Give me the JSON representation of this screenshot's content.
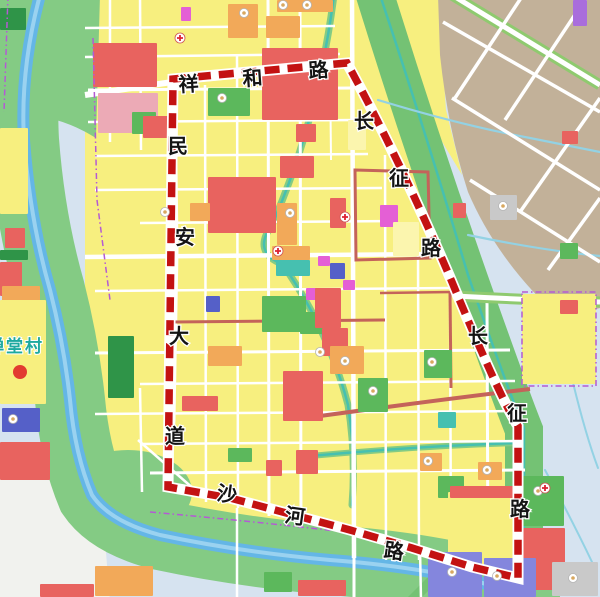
{
  "map": {
    "title": "urban planning zoning map with red dashed project boundary",
    "palette": {
      "bg": "#d6e3f0",
      "whitezone": "#f1f2ee",
      "yellow": "#f7ef7f",
      "yellow2": "#fbf5ae",
      "tan": "#c2b199",
      "corridor": "#84cb84",
      "band": "#74c274",
      "green": "#5cb85c",
      "dkgreen": "#2f9448",
      "river": "#64b6e6",
      "riverlight": "#9ad2f0",
      "stream": "#46c0b0",
      "lightstream": "#93d2e4",
      "red": "#e8635f",
      "pink": "#ecaab6",
      "orange": "#f2a959",
      "magenta": "#e45fd5",
      "blue": "#5560c8",
      "purpleblue": "#8486dd",
      "purple": "#a96ddc",
      "gray": "#c9c9c9",
      "white": "#ffffff",
      "brick": "#c4635a",
      "boundary": "#c31212",
      "casing": "#ffffff",
      "purpleline": "#b45ad4",
      "label": "#141414",
      "village": "#1ea9a0",
      "roadgreen": "#8fca6f"
    },
    "base": [
      {
        "d": "M-5,-5 L605,-5 L605,602 L-5,602 Z",
        "c": "bg"
      },
      {
        "d": "M-5,462 L55,472 Q70,510 105,540 L110,602 L-5,602 Z",
        "c": "whitezone"
      },
      {
        "d": "M85,-5 L360,-5 Q405,155 455,285 Q500,398 518,428 L518,568 L160,568 L148,520 L85,498 Z",
        "c": "yellow"
      },
      {
        "d": "M368,-5 L438,-5 L446,110 L462,175 L428,118 Q398,58 386,18 Z",
        "c": "yellow"
      },
      {
        "d": "M438,-5 L600,-5 L600,308 L560,318 Q498,262 468,192 Q448,130 440,55 Z",
        "c": "tan"
      },
      {
        "d": "M-5,-5 L100,-5 L96,138 Q48,108 -5,116 Z",
        "c": "corridor"
      },
      {
        "e": [
          128,
          492,
          64,
          42
        ],
        "c": "corridor"
      }
    ],
    "corridor_strokes": [
      {
        "d": "M40,-5 Q20,70 24,140 Q30,220 50,290 Q64,345 70,400 Q75,455 92,495 Q110,522 160,535 Q240,552 330,560 Q410,566 470,580 Q505,588 525,597",
        "c": "corridor",
        "w": 70
      },
      {
        "d": "M375,-5 Q420,140 470,282 Q510,395 524,430 L524,540",
        "c": "band",
        "w": 38
      },
      {
        "d": "M412,600 L468,544",
        "c": "band",
        "w": 10
      },
      {
        "d": "M40,-5 Q20,70 24,140 Q30,220 50,290 Q64,345 70,400 Q75,455 92,495 Q110,522 160,535 Q240,552 330,560 Q410,566 470,580 Q505,588 525,597",
        "c": "river",
        "w": 12
      },
      {
        "d": "M40,-5 Q20,70 24,140 Q30,220 50,290 Q64,345 70,400 Q75,455 92,495 Q110,522 160,535 Q240,552 330,560 Q410,566 470,580 Q505,588 525,597",
        "c": "riverlight",
        "w": 4
      }
    ],
    "streams": [
      {
        "d": "M334,-5 Q318,120 272,225 Q252,252 282,264",
        "w": 2.5,
        "c": "stream",
        "case": 7
      },
      {
        "d": "M288,272 Q330,335 348,405 Q356,455 352,505",
        "w": 2.5,
        "c": "stream",
        "case": 7
      },
      {
        "d": "M310,456 Q420,446 518,443",
        "w": 2.5,
        "c": "stream",
        "case": 6
      },
      {
        "d": "M380,-5 Q425,130 468,275 Q508,390 524,428 L524,535",
        "w": 2.5,
        "c": "stream"
      },
      {
        "d": "M378,100 Q460,125 530,138 Q570,146 600,152",
        "w": 2.2,
        "c": "lightstream"
      },
      {
        "d": "M468,235 Q540,250 600,256",
        "w": 2.2,
        "c": "lightstream"
      },
      {
        "d": "M560,325 Q580,420 598,468",
        "w": 2,
        "c": "lightstream"
      },
      {
        "d": "M545,470 Q572,520 592,562",
        "w": 2,
        "c": "lightstream"
      }
    ],
    "roads": [
      {
        "d": "M85,95 L172,82 L347,65",
        "w": 6
      },
      {
        "d": "M174,80 L176,250 L173,420 L168,488",
        "w": 5
      },
      {
        "d": "M110,-5 L110,142",
        "w": 2.5
      },
      {
        "d": "M140,-5 L141,150",
        "w": 2.5
      },
      {
        "d": "M140,388 L142,492",
        "w": 2.5
      },
      {
        "d": "M205,85 L206,502",
        "w": 2.5
      },
      {
        "d": "M237,56 L238,508",
        "w": 2.5
      },
      {
        "d": "M237,508 L237,600",
        "w": 2.5
      },
      {
        "d": "M268,-5 L269,516",
        "w": 3
      },
      {
        "d": "M300,-5 L301,528",
        "w": 3
      },
      {
        "d": "M330,62 L331,160",
        "w": 2
      },
      {
        "d": "M352,-5 L353,250",
        "w": 4.5
      },
      {
        "d": "M353,250 L354,558",
        "w": 4.5
      },
      {
        "d": "M354,558 L354,600",
        "w": 3
      },
      {
        "d": "M385,155 L386,560",
        "w": 2.5
      },
      {
        "d": "M418,255 L419,560",
        "w": 2.5
      },
      {
        "d": "M450,292 L451,566",
        "w": 2.5
      },
      {
        "d": "M487,300 L488,572",
        "w": 3
      },
      {
        "d": "M420,548 L421,600",
        "w": 2.5
      },
      {
        "d": "M85,28 L335,26",
        "w": 2.5
      },
      {
        "d": "M85,57 L340,54",
        "w": 2.5
      },
      {
        "d": "M88,90 L352,88",
        "w": 3
      },
      {
        "d": "M88,122 L358,120",
        "w": 2.5
      },
      {
        "d": "M95,156 L368,154",
        "w": 2.5
      },
      {
        "d": "M95,190 L382,188",
        "w": 2.5
      },
      {
        "d": "M140,223 L395,221",
        "w": 2.5
      },
      {
        "d": "M85,257 L435,254",
        "w": 4.5
      },
      {
        "d": "M95,291 L452,288",
        "w": 2.5
      },
      {
        "d": "M95,353 L510,350",
        "w": 3
      },
      {
        "d": "M140,384 L515,381",
        "w": 2.5
      },
      {
        "d": "M95,414 L518,411",
        "w": 2.5
      },
      {
        "d": "M140,444 L518,441",
        "w": 2.5
      },
      {
        "d": "M150,473 L525,470",
        "w": 3
      },
      {
        "d": "M138,440 L195,490",
        "w": 2.5
      },
      {
        "d": "M452,-5 L600,85",
        "w": 5,
        "case": {
          "c": "roadgreen",
          "w": 11
        }
      },
      {
        "d": "M443,22 L600,112",
        "w": 3.5
      },
      {
        "d": "M452,98 L600,190",
        "w": 3.5
      },
      {
        "d": "M470,180 L600,262",
        "w": 3.5
      },
      {
        "d": "M523,-5 L455,98",
        "w": 3.5
      },
      {
        "d": "M588,-5 L505,120",
        "w": 3.5
      },
      {
        "d": "M600,98 L520,212",
        "w": 3.5
      },
      {
        "d": "M600,198 L548,270",
        "w": 3.5
      },
      {
        "d": "M455,296 Q530,300 600,302",
        "w": 5,
        "case": {
          "c": "roadgreen",
          "w": 11
        }
      },
      {
        "d": "M355,170 L428,172 L430,258 L356,260 Z",
        "w": 3,
        "c": "brick"
      },
      {
        "d": "M172,322 L385,320",
        "w": 3,
        "c": "brick"
      },
      {
        "d": "M320,416 Q430,401 530,389",
        "w": 4,
        "c": "brick"
      },
      {
        "d": "M450,292 L451,388",
        "w": 3,
        "c": "brick"
      },
      {
        "d": "M380,293 L452,292",
        "w": 2.5,
        "c": "brick"
      }
    ],
    "parcels": [
      [
        93,
        43,
        64,
        44,
        "red"
      ],
      [
        98,
        93,
        60,
        40,
        "pink"
      ],
      [
        132,
        112,
        24,
        22,
        "green"
      ],
      [
        181,
        7,
        10,
        14,
        "magenta"
      ],
      [
        228,
        4,
        30,
        34,
        "orange"
      ],
      [
        266,
        16,
        34,
        22,
        "orange"
      ],
      [
        277,
        0,
        56,
        12,
        "orange"
      ],
      [
        262,
        48,
        76,
        72,
        "red"
      ],
      [
        296,
        124,
        20,
        18,
        "red"
      ],
      [
        208,
        88,
        42,
        28,
        "green"
      ],
      [
        143,
        116,
        26,
        22,
        "red"
      ],
      [
        208,
        177,
        68,
        56,
        "red"
      ],
      [
        277,
        203,
        20,
        42,
        "orange"
      ],
      [
        280,
        156,
        34,
        22,
        "red"
      ],
      [
        190,
        203,
        20,
        18,
        "orange"
      ],
      [
        206,
        296,
        14,
        16,
        "blue"
      ],
      [
        272,
        246,
        38,
        14,
        "orange"
      ],
      [
        276,
        260,
        34,
        16,
        "stream"
      ],
      [
        262,
        296,
        44,
        36,
        "green"
      ],
      [
        300,
        312,
        28,
        22,
        "green"
      ],
      [
        318,
        256,
        12,
        10,
        "magenta"
      ],
      [
        306,
        288,
        12,
        12,
        "magenta"
      ],
      [
        343,
        280,
        12,
        10,
        "magenta"
      ],
      [
        380,
        205,
        18,
        22,
        "magenta"
      ],
      [
        315,
        288,
        26,
        40,
        "red"
      ],
      [
        330,
        198,
        16,
        30,
        "red"
      ],
      [
        330,
        263,
        15,
        16,
        "blue"
      ],
      [
        283,
        371,
        40,
        50,
        "red"
      ],
      [
        322,
        328,
        26,
        28,
        "red"
      ],
      [
        208,
        346,
        34,
        20,
        "orange"
      ],
      [
        330,
        346,
        34,
        28,
        "orange"
      ],
      [
        358,
        378,
        30,
        34,
        "green"
      ],
      [
        424,
        350,
        28,
        28,
        "green"
      ],
      [
        438,
        412,
        18,
        16,
        "stream"
      ],
      [
        420,
        453,
        22,
        18,
        "orange"
      ],
      [
        478,
        462,
        24,
        18,
        "orange"
      ],
      [
        438,
        476,
        26,
        22,
        "green"
      ],
      [
        296,
        450,
        22,
        24,
        "red"
      ],
      [
        182,
        396,
        36,
        15,
        "red"
      ],
      [
        266,
        460,
        16,
        16,
        "red"
      ],
      [
        228,
        448,
        24,
        14,
        "green"
      ],
      [
        0,
        8,
        26,
        22,
        "dkgreen"
      ],
      [
        0,
        128,
        28,
        86,
        "yellow"
      ],
      [
        5,
        228,
        20,
        20,
        "red"
      ],
      [
        0,
        250,
        28,
        10,
        "dkgreen"
      ],
      [
        0,
        262,
        22,
        34,
        "red"
      ],
      [
        2,
        286,
        38,
        24,
        "orange"
      ],
      [
        0,
        300,
        46,
        104,
        "yellow"
      ],
      [
        2,
        408,
        38,
        24,
        "blue"
      ],
      [
        108,
        336,
        26,
        62,
        "dkgreen"
      ],
      [
        0,
        442,
        50,
        38,
        "red"
      ],
      [
        522,
        294,
        74,
        90,
        "yellow"
      ],
      [
        560,
        300,
        18,
        14,
        "red"
      ],
      [
        522,
        476,
        42,
        50,
        "green"
      ],
      [
        519,
        528,
        46,
        62,
        "red"
      ],
      [
        552,
        562,
        46,
        34,
        "gray"
      ],
      [
        448,
        492,
        68,
        76,
        "yellow"
      ],
      [
        450,
        486,
        66,
        12,
        "red"
      ],
      [
        428,
        552,
        54,
        45,
        "purpleblue"
      ],
      [
        484,
        558,
        52,
        39,
        "purpleblue"
      ],
      [
        95,
        566,
        58,
        30,
        "orange"
      ],
      [
        40,
        584,
        54,
        13,
        "red"
      ],
      [
        264,
        572,
        28,
        20,
        "green"
      ],
      [
        298,
        580,
        48,
        16,
        "red"
      ],
      [
        562,
        131,
        16,
        13,
        "red"
      ],
      [
        453,
        203,
        13,
        15,
        "red"
      ],
      [
        560,
        243,
        18,
        16,
        "green"
      ],
      [
        490,
        195,
        27,
        25,
        "gray"
      ],
      [
        573,
        0,
        14,
        26,
        "purple"
      ],
      [
        393,
        222,
        26,
        34,
        "yellow2"
      ],
      [
        348,
        120,
        18,
        30,
        "yellow2"
      ]
    ],
    "purple_lines": [
      {
        "d": "M93,38 L97,200 L110,300"
      },
      {
        "d": "M8,-5 L4,112"
      },
      {
        "d": "M150,512 Q250,521 345,532"
      },
      {
        "d": "M522,292 L596,292 L596,386 L522,386 Z"
      }
    ],
    "boundary": {
      "d": "M173,79 L347,63 Q400,160 452,282 Q500,398 518,426 L518,578 L472,567 L412,548 L350,530 L290,514 L230,498 L168,487 Z",
      "casing_w": 11,
      "w": 7.5,
      "dash": "15 8"
    },
    "road_labels": [
      {
        "road": "xianghe-road",
        "chars": [
          {
            "t": "祥",
            "x": 189,
            "y": 91,
            "r": -4
          },
          {
            "t": "和",
            "x": 253,
            "y": 85,
            "r": -4
          },
          {
            "t": "路",
            "x": 319,
            "y": 77,
            "r": -4
          }
        ]
      },
      {
        "road": "minan-avenue",
        "chars": [
          {
            "t": "民",
            "x": 178,
            "y": 153,
            "r": 0
          },
          {
            "t": "安",
            "x": 185,
            "y": 244,
            "r": 0
          },
          {
            "t": "大",
            "x": 179,
            "y": 343,
            "r": 0
          },
          {
            "t": "道",
            "x": 175,
            "y": 443,
            "r": 0
          }
        ]
      },
      {
        "road": "changzheng-road-upper",
        "chars": [
          {
            "t": "长",
            "x": 364,
            "y": 128,
            "r": 0
          },
          {
            "t": "征",
            "x": 399,
            "y": 185,
            "r": 0
          },
          {
            "t": "路",
            "x": 431,
            "y": 255,
            "r": 0
          }
        ]
      },
      {
        "road": "changzheng-road-lower",
        "chars": [
          {
            "t": "长",
            "x": 478,
            "y": 343,
            "r": 0
          },
          {
            "t": "征",
            "x": 517,
            "y": 420,
            "r": 0
          },
          {
            "t": "路",
            "x": 520,
            "y": 516,
            "r": 0
          }
        ]
      },
      {
        "road": "shahe-road",
        "chars": [
          {
            "t": "沙",
            "x": 226,
            "y": 501,
            "r": 8
          },
          {
            "t": "河",
            "x": 294,
            "y": 523,
            "r": 8
          },
          {
            "t": "路",
            "x": 393,
            "y": 558,
            "r": 8
          }
        ]
      }
    ],
    "place_labels": [
      {
        "name": "chantang-village",
        "text": "禅堂村",
        "x": -13,
        "y": 352,
        "color": "#1ea9a0",
        "size": 17
      }
    ],
    "icons": {
      "circles": [
        [
          244,
          13
        ],
        [
          283,
          5
        ],
        [
          307,
          5
        ],
        [
          222,
          98
        ],
        [
          290,
          213
        ],
        [
          320,
          352
        ],
        [
          345,
          361
        ],
        [
          373,
          391
        ],
        [
          432,
          362
        ],
        [
          428,
          461
        ],
        [
          487,
          470
        ],
        [
          503,
          206
        ],
        [
          538,
          491
        ],
        [
          573,
          578
        ],
        [
          452,
          572
        ],
        [
          497,
          576
        ],
        [
          13,
          419
        ],
        [
          165,
          212
        ]
      ],
      "crosses": [
        [
          180,
          38
        ],
        [
          278,
          251
        ],
        [
          345,
          217
        ],
        [
          545,
          488
        ]
      ],
      "red_dots": [
        [
          20,
          372
        ]
      ]
    }
  }
}
